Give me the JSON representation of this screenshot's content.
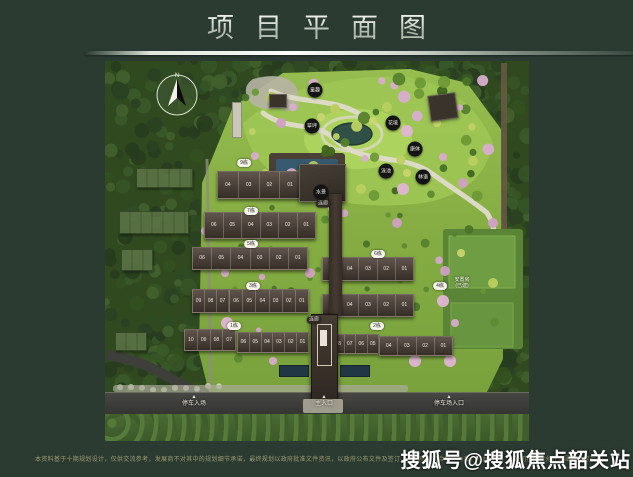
{
  "header": {
    "title": "项目平面图"
  },
  "map": {
    "compass": "N",
    "badges": [
      "9栋",
      "7栋",
      "5栋",
      "6栋",
      "3栋",
      "4栋",
      "1栋",
      "2栋"
    ],
    "rows": [
      {
        "id": "r9",
        "units": [
          "04",
          "03",
          "02",
          "01"
        ]
      },
      {
        "id": "r7",
        "units": [
          "06",
          "05",
          "04",
          "03",
          "02",
          "01"
        ]
      },
      {
        "id": "r5",
        "units": [
          "06",
          "05",
          "04",
          "03",
          "02",
          "01"
        ]
      },
      {
        "id": "r6",
        "units": [
          "05",
          "04",
          "03",
          "02",
          "01"
        ]
      },
      {
        "id": "r3a",
        "units": [
          "09",
          "08",
          "07"
        ]
      },
      {
        "id": "r3b",
        "units": [
          "06",
          "05",
          "04",
          "03",
          "02",
          "01"
        ]
      },
      {
        "id": "r4",
        "units": [
          "05",
          "04",
          "03",
          "02",
          "01"
        ]
      },
      {
        "id": "r1a",
        "units": [
          "10",
          "09",
          "08",
          "07"
        ]
      },
      {
        "id": "r1b",
        "units": [
          "06",
          "05",
          "04",
          "03",
          "02",
          "01"
        ]
      },
      {
        "id": "r2a",
        "units": [
          "08",
          "07",
          "06",
          "05"
        ]
      },
      {
        "id": "r2b",
        "units": [
          "04",
          "03",
          "02",
          "01"
        ]
      }
    ],
    "corridor_labels": [
      "连廊",
      "连廊"
    ],
    "facilities": [
      "童趣",
      "草坪",
      "花境",
      "康体",
      "泳池",
      "水景",
      "林语"
    ],
    "area_label": [
      "安置房",
      "(已建)"
    ],
    "entrances": [
      "停车入场",
      "主入口",
      "停车场入口"
    ]
  },
  "footer": {
    "disclaimer": "本资料基于十期规划设计，仅供交流参考，发展商不对其中的规划细节承诺，最终规划以政府批准文件资讯，以政府公布文件及签订《商品房买卖合同》为准，特此声明，本公司在法律允许范围内保留对有关资料的修改权利，敬请留意最新资讯。",
    "watermark": "搜狐号@搜狐焦点韶关站"
  }
}
